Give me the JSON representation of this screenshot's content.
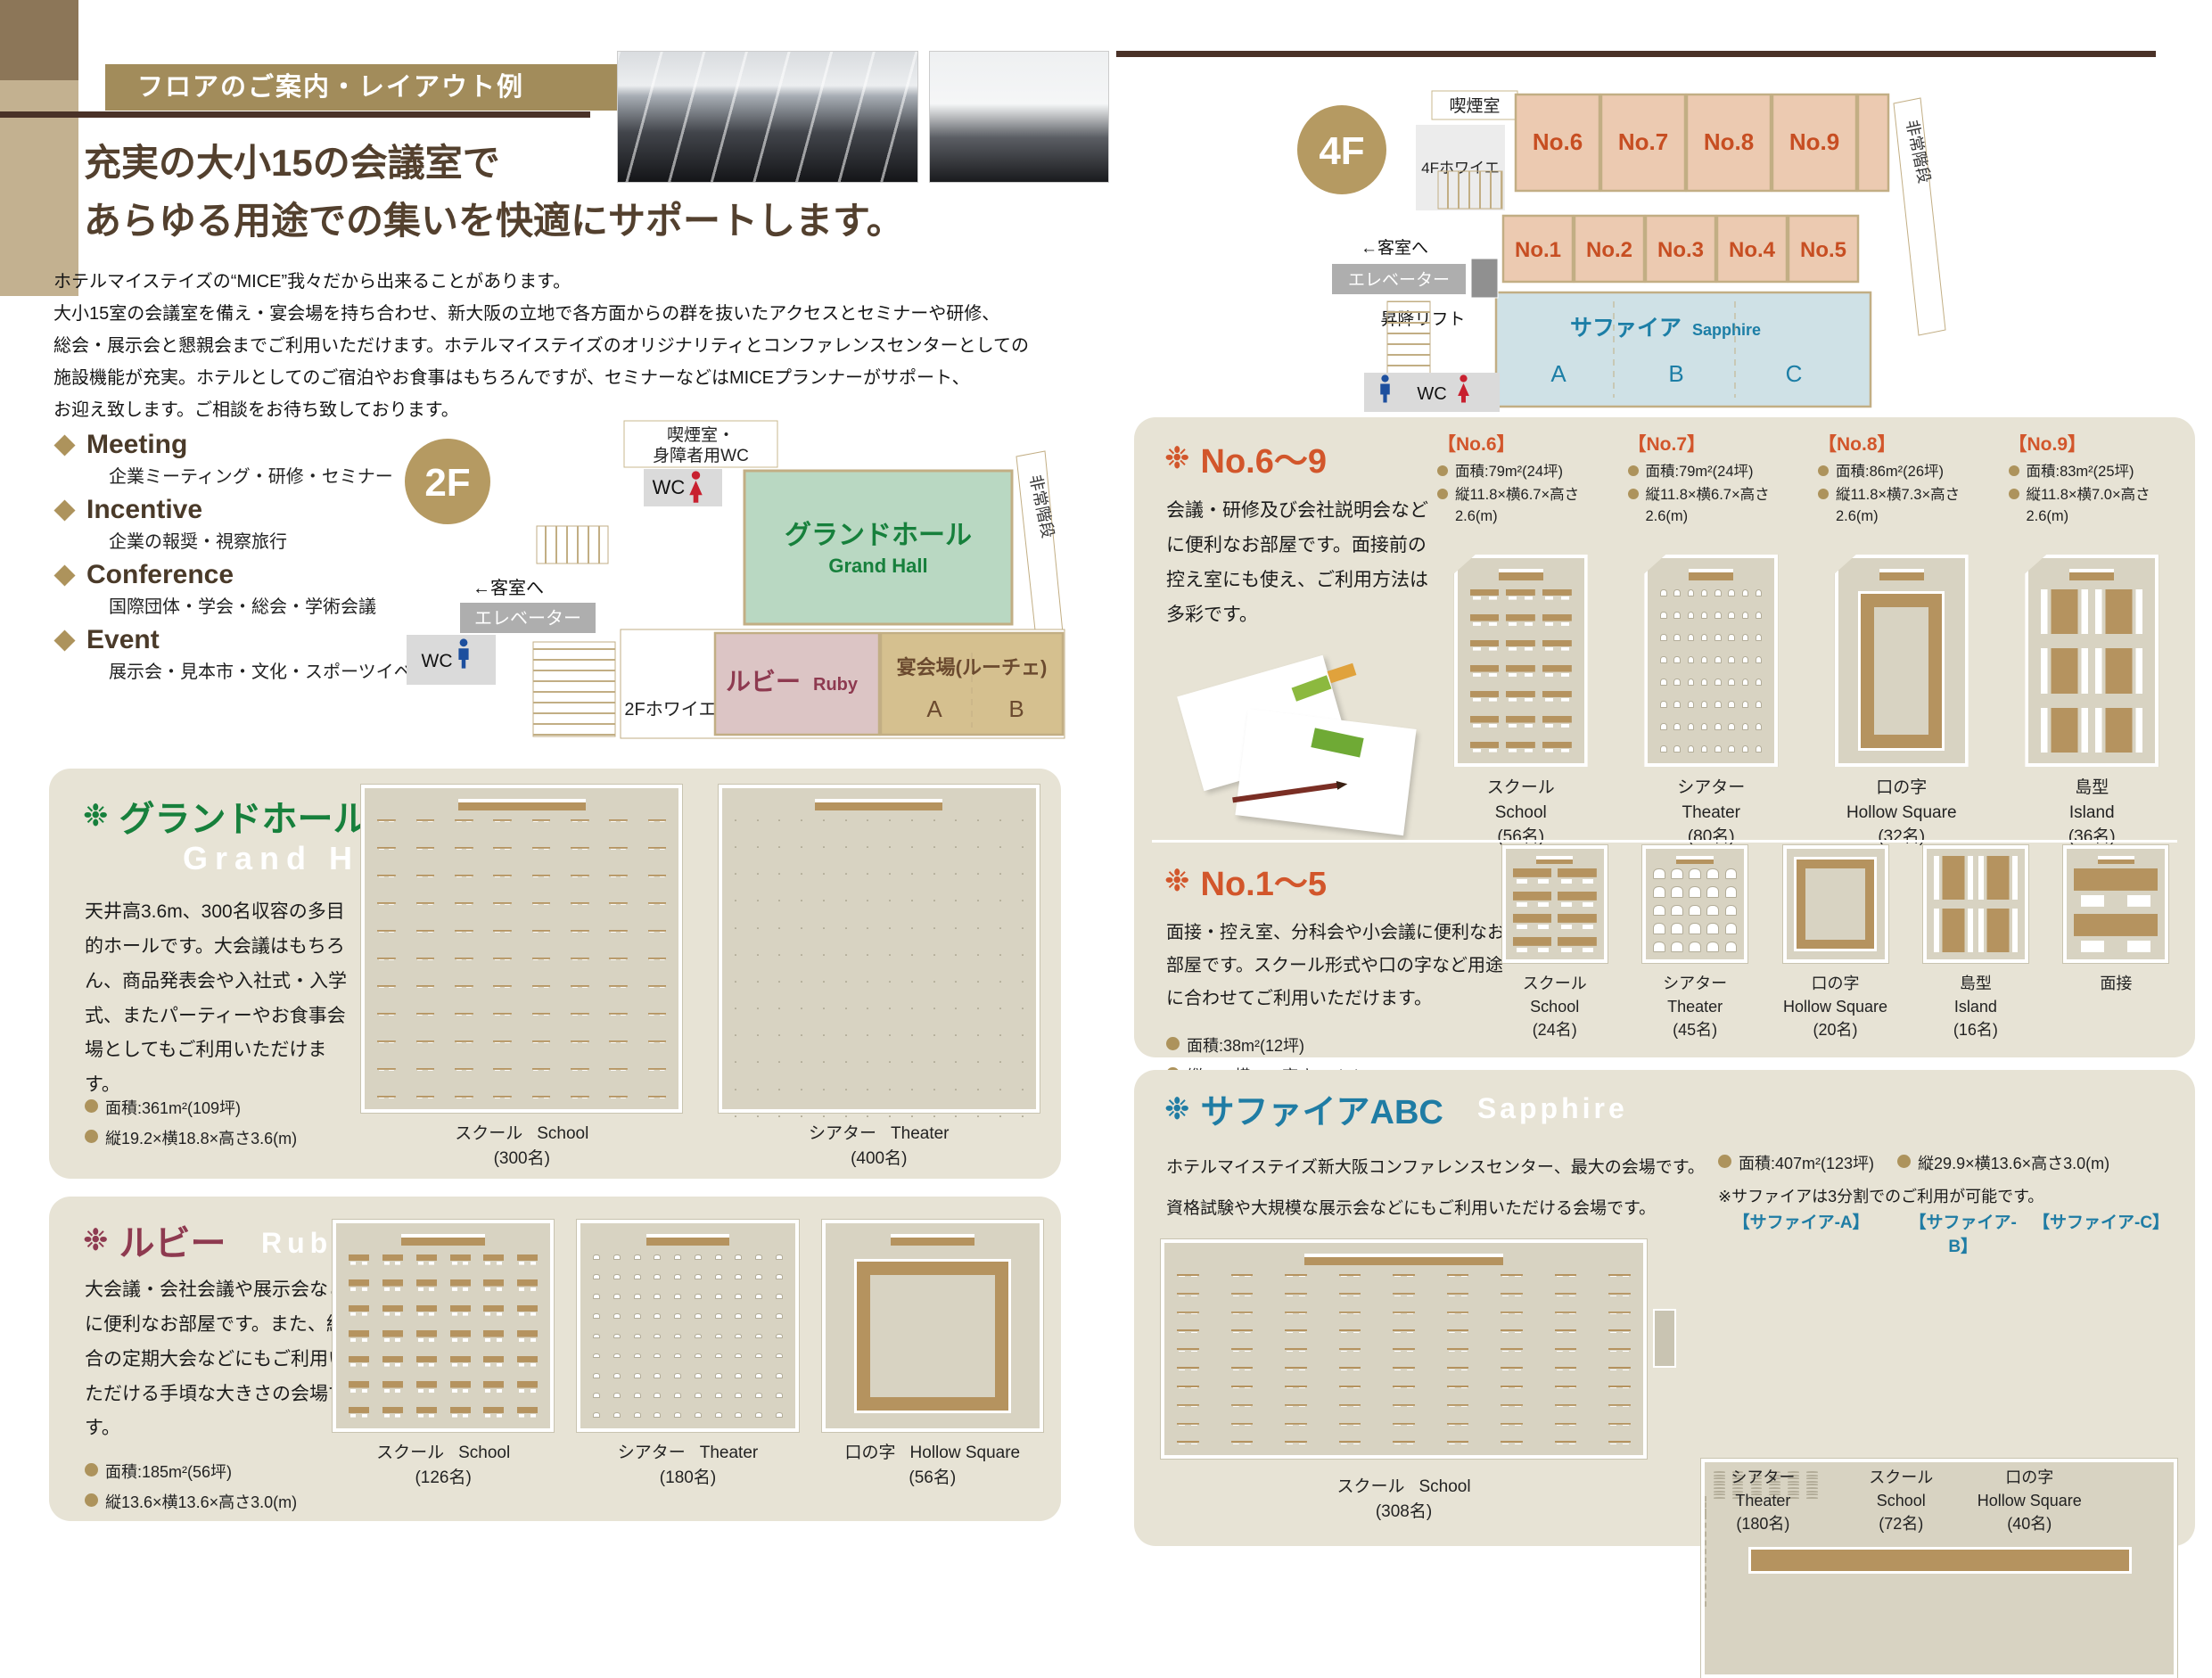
{
  "colors": {
    "accent_tan": "#ad935c",
    "dark_brown": "#4a3228",
    "orange": "#d2562b",
    "green": "#17803c",
    "ruby": "#8e3a50",
    "blue": "#1f7ca4",
    "salmon": "#eccab1",
    "sapphire_fill": "#cfe1e6",
    "grand_fill": "#b9d8c2",
    "ruby_fill": "#dcc5c5",
    "banquet_fill": "#d5c08f",
    "card_bg": "#e7e3d5"
  },
  "header": {
    "ribbon": "フロアのご案内・レイアウト例",
    "headline1": "充実の大小15の会議室で",
    "headline2": "あらゆる用途での集いを快適にサポートします。",
    "intro": [
      "ホテルマイステイズの“MICE”我々だから出来ることがあります。",
      "大小15室の会議室を備え・宴会場を持ち合わせ、新大阪の立地で各方面からの群を抜いたアクセスとセミナーや研修、",
      "総会・展示会と懇親会までご利用いただけます。ホテルマイステイズのオリジナリティとコンファレンスセンターとしての",
      "施設機能が充実。ホテルとしてのご宿泊やお食事はもちろんですが、セミナーなどはMICEプランナーがサポート、",
      "お迎え致します。ご相談をお待ち致しております。"
    ],
    "mice": [
      {
        "en": "Meeting",
        "ja": "企業ミーティング・研修・セミナー"
      },
      {
        "en": "Incentive",
        "ja": "企業の報奨・視察旅行"
      },
      {
        "en": "Conference",
        "ja": "国際団体・学会・総会・学術会議"
      },
      {
        "en": "Event",
        "ja": "展示会・見本市・文化・スポーツイベント"
      }
    ]
  },
  "floor2": {
    "badge": "2F",
    "smoking1": "喫煙室・",
    "smoking2": "身障者用WC",
    "wc": "WC",
    "grand_ja": "グランドホール",
    "grand_en": "Grand Hall",
    "stairs": "非常階段",
    "to_guest": "←客室へ",
    "elevator": "エレベーター",
    "wc2": "WC",
    "foyer": "2Fホワイエ",
    "ruby_ja": "ルビー",
    "ruby_en": "Ruby",
    "banquet": "宴会場(ルーチェ)",
    "part_a": "A",
    "part_b": "B"
  },
  "floor4": {
    "badge": "4F",
    "smoking": "喫煙室",
    "foyer": "4Fホワイエ",
    "rooms_top": [
      "No.6",
      "No.7",
      "No.8",
      "No.9"
    ],
    "rooms_mid": [
      "No.1",
      "No.2",
      "No.3",
      "No.4",
      "No.5"
    ],
    "to_guest": "←客室へ",
    "elevator": "エレベーター",
    "lift": "昇降リフト",
    "stairs": "非常階段",
    "sapphire_ja": "サファイア",
    "sapphire_en": "Sapphire",
    "part_a": "A",
    "part_b": "B",
    "part_c": "C",
    "wc": "WC"
  },
  "grand": {
    "ornament": "❉",
    "title_ja": "グランドホール",
    "title_en": "Grand Hall",
    "desc": "天井高3.6m、300名収容の多目的ホールです。大会議はもちろん、商品発表会や入社式・入学式、またパーティーやお食事会場としてもご利用いただけます。",
    "spec_area": "面積:361m²(109坪)",
    "spec_dims": "縦19.2×横18.8×高さ3.6(m)",
    "layouts": [
      {
        "ja": "スクール",
        "en": "School",
        "cap": "(300名)",
        "diagram": {
          "kind": "school",
          "cols": 8,
          "rows": 11,
          "podium": true
        }
      },
      {
        "ja": "シアター",
        "en": "Theater",
        "cap": "(400名)",
        "diagram": {
          "kind": "theater",
          "cols": 14,
          "rows": 12,
          "podium": true
        }
      }
    ]
  },
  "ruby": {
    "ornament": "❉",
    "title_ja": "ルビー",
    "title_en": "Ruby",
    "desc": "大会議・会社会議や展示会などに便利なお部屋です。また、組合の定期大会などにもご利用いただける手頃な大きさの会場です。",
    "spec_area": "面積:185m²(56坪)",
    "spec_dims": "縦13.6×横13.6×高さ3.0(m)",
    "layouts": [
      {
        "ja": "スクール",
        "en": "School",
        "cap": "(126名)",
        "diagram": {
          "kind": "school",
          "cols": 6,
          "rows": 7,
          "podium": true
        }
      },
      {
        "ja": "シアター",
        "en": "Theater",
        "cap": "(180名)",
        "diagram": {
          "kind": "theater",
          "cols": 10,
          "rows": 9,
          "podium": true
        }
      },
      {
        "ja": "口の字",
        "en": "Hollow Square",
        "cap": "(56名)",
        "diagram": {
          "kind": "hollow",
          "podium": true
        }
      }
    ]
  },
  "no69": {
    "ornament": "❉",
    "title": "No.6〜9",
    "desc": "会議・研修及び会社説明会などに便利なお部屋です。面接前の控え室にも使え、ご利用方法は多彩です。",
    "rooms": [
      {
        "name": "【No.6】",
        "spec_area": "面積:79m²(24坪)",
        "spec_dims": "縦11.8×横6.7×高さ2.6(m)",
        "ja": "スクール",
        "en": "School",
        "cap": "(56名)",
        "diagram": {
          "kind": "school",
          "cols": 3,
          "rows": 7,
          "podium": true
        }
      },
      {
        "name": "【No.7】",
        "spec_area": "面積:79m²(24坪)",
        "spec_dims": "縦11.8×横6.7×高さ2.6(m)",
        "ja": "シアター",
        "en": "Theater",
        "cap": "(80名)",
        "diagram": {
          "kind": "theater",
          "cols": 8,
          "rows": 8,
          "podium": true
        }
      },
      {
        "name": "【No.8】",
        "spec_area": "面積:86m²(26坪)",
        "spec_dims": "縦11.8×横7.3×高さ2.6(m)",
        "ja": "口の字",
        "en": "Hollow Square",
        "cap": "(32名)",
        "diagram": {
          "kind": "hollow",
          "podium": true
        }
      },
      {
        "name": "【No.9】",
        "spec_area": "面積:83m²(25坪)",
        "spec_dims": "縦11.8×横7.0×高さ2.6(m)",
        "ja": "島型",
        "en": "Island",
        "cap": "(36名)",
        "diagram": {
          "kind": "island",
          "cols": 2,
          "rows": 3,
          "podium": true
        }
      }
    ]
  },
  "no15": {
    "ornament": "❉",
    "title": "No.1〜5",
    "desc": "面接・控え室、分科会や小会議に便利なお部屋です。スクール形式や口の字など用途に合わせてご利用いただけます。",
    "spec_area": "面積:38m²(12坪)",
    "spec_dims": "縦6.9×横5.5×高さ2.6(m)",
    "layouts": [
      {
        "ja": "スクール",
        "en": "School",
        "cap": "(24名)",
        "diagram": {
          "kind": "school",
          "cols": 2,
          "rows": 4,
          "podium": true
        }
      },
      {
        "ja": "シアター",
        "en": "Theater",
        "cap": "(45名)",
        "diagram": {
          "kind": "theater",
          "cols": 5,
          "rows": 5,
          "podium": true
        }
      },
      {
        "ja": "口の字",
        "en": "Hollow Square",
        "cap": "(20名)",
        "diagram": {
          "kind": "hollow"
        }
      },
      {
        "ja": "島型",
        "en": "Island",
        "cap": "(16名)",
        "diagram": {
          "kind": "island",
          "cols": 2,
          "rows": 2
        }
      },
      {
        "ja": "面接",
        "en": "",
        "cap": "",
        "diagram": {
          "kind": "school",
          "cols": 1,
          "rows": 2,
          "podium": true
        }
      }
    ]
  },
  "sapphire": {
    "ornament": "❉",
    "title_ja": "サファイアABC",
    "title_en": "Sapphire",
    "desc1": "ホテルマイステイズ新大阪コンファレンスセンター、最大の会場です。",
    "desc2": "資格試験や大規模な展示会などにもご利用いただける会場です。",
    "spec_area": "面積:407m²(123坪)",
    "spec_dims": "縦29.9×横13.6×高さ3.0(m)",
    "note": "※サファイアは3分割でのご利用が可能です。",
    "subs": [
      "【サファイア-A】",
      "【サファイア-B】",
      "【サファイア-C】"
    ],
    "left": {
      "ja": "スクール",
      "en": "School",
      "cap": "(308名)",
      "diagram": {
        "kind": "school",
        "cols": 9,
        "rows": 10,
        "podium": true
      }
    },
    "right": [
      {
        "ja": "シアター",
        "en": "Theater",
        "cap": "(180名)",
        "diagram": {
          "kind": "theater",
          "cols": 6,
          "rows": 9,
          "bare": true
        }
      },
      {
        "ja": "スクール",
        "en": "School",
        "cap": "(72名)",
        "diagram": {
          "kind": "school",
          "cols": 2,
          "rows": 8,
          "bare": true
        }
      },
      {
        "ja": "口の字",
        "en": "Hollow Square",
        "cap": "(40名)",
        "diagram": {
          "kind": "hollow",
          "bare": true
        }
      }
    ]
  }
}
